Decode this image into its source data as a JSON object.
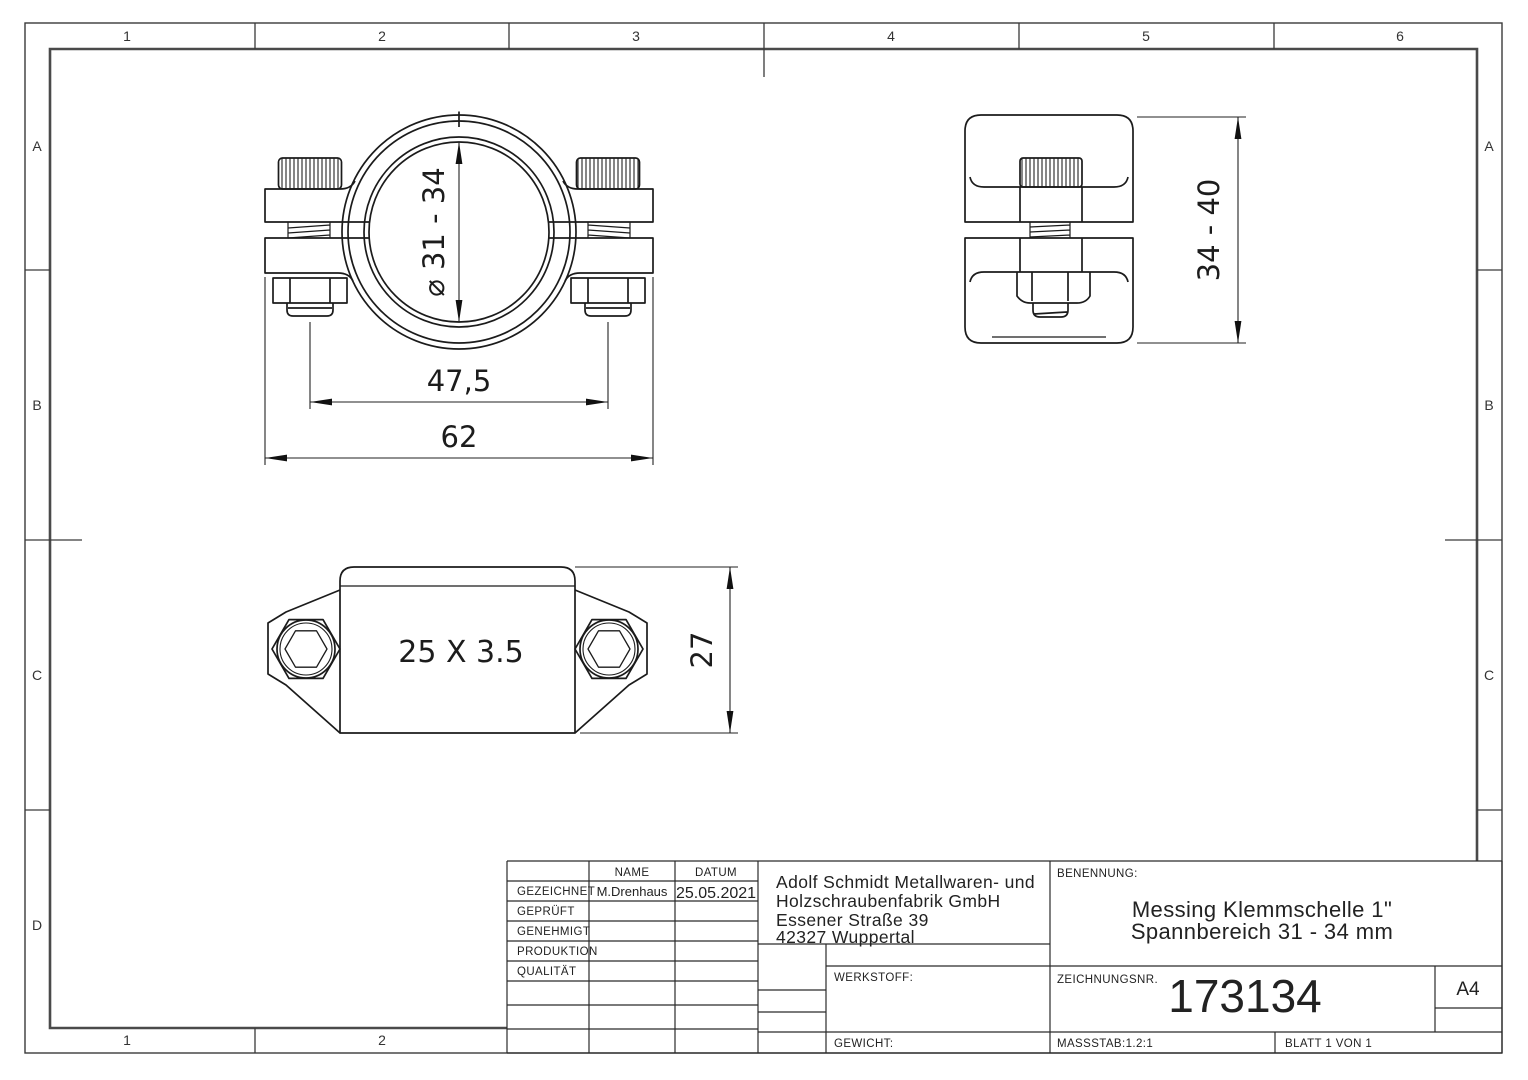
{
  "sheet": {
    "grid": {
      "top": [
        "1",
        "2",
        "3",
        "4",
        "5",
        "6"
      ],
      "bottom": [
        "1",
        "2"
      ],
      "left": [
        "A",
        "B",
        "C",
        "D"
      ],
      "right": [
        "A",
        "B",
        "C"
      ]
    },
    "dimensions": {
      "front_diameter": "⌀ 31 - 34",
      "front_bolt_spacing": "47,5",
      "front_width": "62",
      "side_height": "34 - 40",
      "bottom_profile": "25 X 3.5",
      "bottom_depth": "27"
    },
    "titleblock": {
      "approval": {
        "name_header": "NAME",
        "date_header": "DATUM",
        "rows": [
          {
            "label": "GEZEICHNET",
            "name": "M.Drenhaus",
            "date": "25.05.2021"
          },
          {
            "label": "GEPRÜFT",
            "name": "",
            "date": ""
          },
          {
            "label": "GENEHMIGT",
            "name": "",
            "date": ""
          },
          {
            "label": "PRODUKTION",
            "name": "",
            "date": ""
          },
          {
            "label": "QUALITÄT",
            "name": "",
            "date": ""
          }
        ]
      },
      "company": {
        "lines": [
          "Adolf Schmidt Metallwaren- und",
          "Holzschraubenfabrik GmbH",
          "Essener Straße 39",
          "42327 Wuppertal"
        ]
      },
      "labels": {
        "benennung": "BENENNUNG:",
        "zeichnungsnr": "ZEICHNUNGSNR.",
        "werkstoff": "WERKSTOFF:",
        "gewicht": "GEWICHT:"
      },
      "benennung": {
        "line1": "Messing Klemmschelle 1\"",
        "line2": "Spannbereich 31 - 34 mm"
      },
      "zeichnungsnr": "173134",
      "format": "A4",
      "massstab": "MASSSTAB:1.2:1",
      "blatt": "BLATT 1 VON 1"
    }
  }
}
